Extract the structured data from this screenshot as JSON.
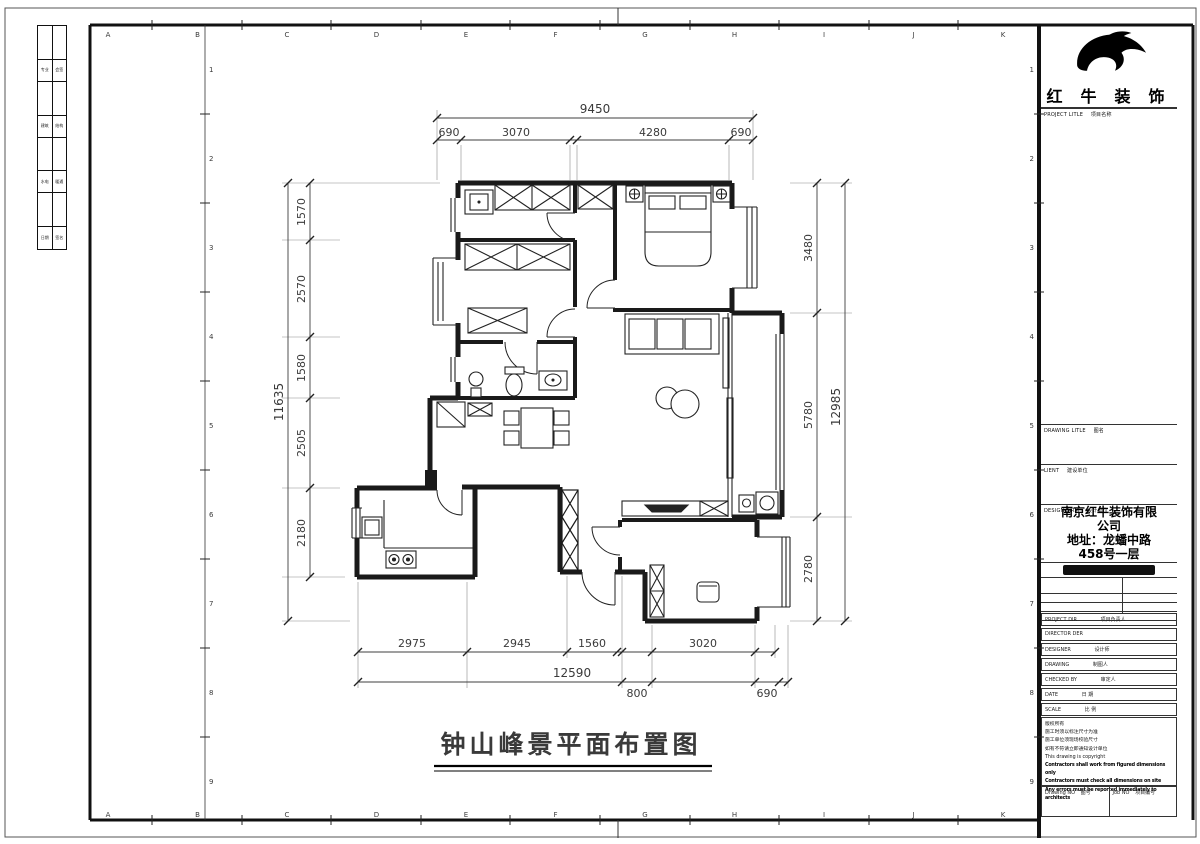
{
  "sheet": {
    "grid_letters": [
      "A",
      "B",
      "C",
      "D",
      "E",
      "F",
      "G",
      "H",
      "I",
      "J",
      "K"
    ],
    "side_numbers": [
      "1",
      "2",
      "3",
      "4",
      "5",
      "6",
      "7",
      "8",
      "9"
    ]
  },
  "sign_strip": {
    "rows": [
      {
        "left": "专业",
        "right": "会签"
      },
      {
        "left": "建筑",
        "right": "结构"
      },
      {
        "left": "水电",
        "right": "暖通"
      },
      {
        "left": "日期",
        "right": "签名"
      }
    ]
  },
  "title_block": {
    "brand": "红牛装饰",
    "project_title_en": "PROJECT LITLE",
    "project_title_zh": "项目名称",
    "drawing_title_en": "DRAWING LITLE",
    "drawing_title_zh": "图名",
    "client_en": "LIENT",
    "client_zh": "建设单位",
    "design_firm_en": "DESIGN FIRM",
    "design_firm_zh": "设计单位",
    "firm_lines": [
      "南京红牛装饰有限",
      "公司",
      "地址：龙蟠中路",
      "458号一层"
    ],
    "staff_rows": [
      {
        "en": "PROJECT DIR",
        "zh": "项目负责人"
      },
      {
        "en": "DIRECTOR DER",
        "zh": ""
      },
      {
        "en": "DESIGNER",
        "zh": "设计师"
      },
      {
        "en": "DRAWING",
        "zh": "制图人"
      },
      {
        "en": "CHECKED BY",
        "zh": "审定人"
      },
      {
        "en": "DATE",
        "zh": "日 期"
      },
      {
        "en": "SCALE",
        "zh": "比 例"
      }
    ],
    "notes": [
      "版权所有",
      "施工时须以标注尺寸为准",
      "施工单位须现场校验尺寸",
      "如有不符请立即通知设计单位",
      "This drawing is copyright",
      "Contractors shall work from figured dimensions only",
      "Contractors must check all dimensions on site",
      "Any errors must be reported immediately to architects"
    ],
    "drawing_no_en": "Drawing NO",
    "drawing_no_zh": "图号",
    "job_no_en": "Job NO",
    "job_no_zh": "项目编号"
  },
  "plan": {
    "title": "钟山峰景平面布置图",
    "dimensions": {
      "top": {
        "total": "9450",
        "segments": [
          "690",
          "3070",
          "4280",
          "690"
        ]
      },
      "left": {
        "total": "11635",
        "segments": [
          "1570",
          "2570",
          "1580",
          "2505",
          "2180"
        ]
      },
      "right": {
        "total": "12985",
        "segments": [
          "3480",
          "5780",
          "2780"
        ]
      },
      "bottom": {
        "total": "12590",
        "segments": [
          "2975",
          "2945",
          "1560",
          "3020"
        ],
        "offsets": [
          "800",
          "690"
        ]
      }
    }
  },
  "colors": {
    "line": "#1a1a1a",
    "dim_text": "#3a3a3a",
    "paper": "#ffffff"
  }
}
